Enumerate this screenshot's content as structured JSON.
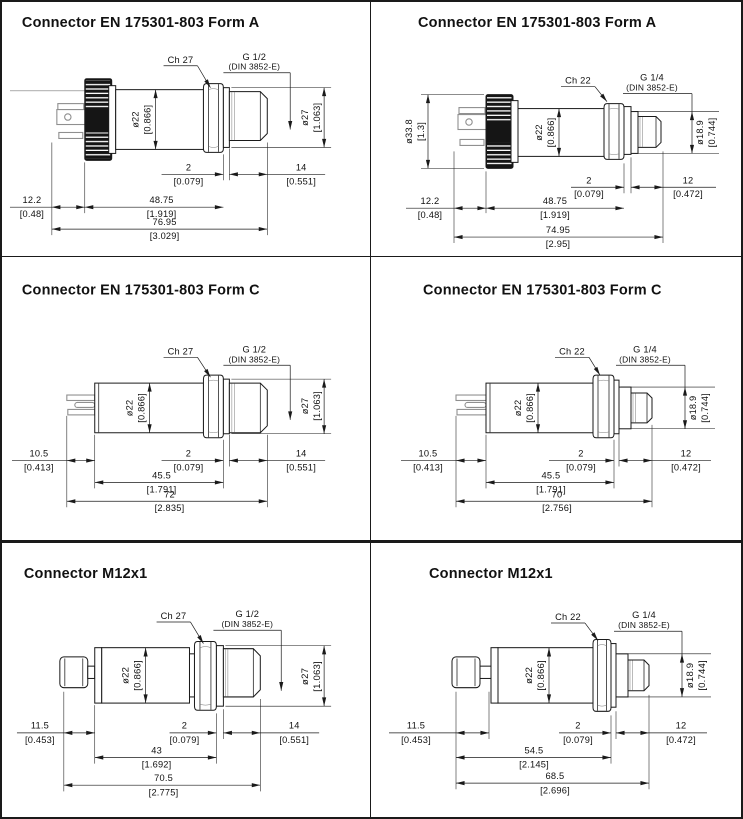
{
  "ink_color": "#1a1a1a",
  "pin_gray_color": "#8f8f8f",
  "panels": [
    {
      "title": "Connector EN 175301-803 Form A",
      "wrench": "Ch 27",
      "thread": "G 1/2",
      "standard": "(DIN 3852-E)",
      "dims": {
        "body_dia_mm": "ø22",
        "body_dia_in": "[0.866]",
        "outlet_dia_mm": "ø27",
        "outlet_dia_in": "[1.063]",
        "seal_mm": "2",
        "seal_in": "[0.079]",
        "thread_len_mm": "14",
        "thread_len_in": "[0.551]",
        "conn_len_mm": "12.2",
        "conn_len_in": "[0.48]",
        "body_len_mm": "48.75",
        "body_len_in": "[1.919]",
        "total_len_mm": "76.95",
        "total_len_in": "[3.029]"
      }
    },
    {
      "title": "Connector EN 175301-803 Form A",
      "wrench": "Ch 22",
      "thread": "G 1/4",
      "standard": "(DIN 3852-E)",
      "dims": {
        "cap_dia_mm": "ø33.8",
        "cap_dia_in": "[1.3]",
        "body_dia_mm": "ø22",
        "body_dia_in": "[0.866]",
        "outlet_dia_mm": "ø18.9",
        "outlet_dia_in": "[0.744]",
        "seal_mm": "2",
        "seal_in": "[0.079]",
        "thread_len_mm": "12",
        "thread_len_in": "[0.472]",
        "conn_len_mm": "12.2",
        "conn_len_in": "[0.48]",
        "body_len_mm": "48.75",
        "body_len_in": "[1.919]",
        "total_len_mm": "74.95",
        "total_len_in": "[2.95]"
      }
    },
    {
      "title": "Connector EN 175301-803 Form C",
      "wrench": "Ch 27",
      "thread": "G 1/2",
      "standard": "(DIN 3852-E)",
      "dims": {
        "body_dia_mm": "ø22",
        "body_dia_in": "[0.866]",
        "outlet_dia_mm": "ø27",
        "outlet_dia_in": "[1.063]",
        "seal_mm": "2",
        "seal_in": "[0.079]",
        "thread_len_mm": "14",
        "thread_len_in": "[0.551]",
        "conn_len_mm": "10.5",
        "conn_len_in": "[0.413]",
        "body_len_mm": "45.5",
        "body_len_in": "[1.791]",
        "total_len_mm": "72",
        "total_len_in": "[2.835]"
      }
    },
    {
      "title": "Connector EN 175301-803 Form C",
      "wrench": "Ch 22",
      "thread": "G 1/4",
      "standard": "(DIN 3852-E)",
      "dims": {
        "body_dia_mm": "ø22",
        "body_dia_in": "[0.866]",
        "outlet_dia_mm": "ø18.9",
        "outlet_dia_in": "[0.744]",
        "seal_mm": "2",
        "seal_in": "[0.079]",
        "thread_len_mm": "12",
        "thread_len_in": "[0.472]",
        "conn_len_mm": "10.5",
        "conn_len_in": "[0.413]",
        "body_len_mm": "45.5",
        "body_len_in": "[1.791]",
        "total_len_mm": "70",
        "total_len_in": "[2.756]"
      }
    },
    {
      "title": "Connector M12x1",
      "wrench": "Ch 27",
      "thread": "G 1/2",
      "standard": "(DIN 3852-E)",
      "dims": {
        "body_dia_mm": "ø22",
        "body_dia_in": "[0.866]",
        "outlet_dia_mm": "ø27",
        "outlet_dia_in": "[1.063]",
        "seal_mm": "2",
        "seal_in": "[0.079]",
        "thread_len_mm": "14",
        "thread_len_in": "[0.551]",
        "conn_len_mm": "11.5",
        "conn_len_in": "[0.453]",
        "body_len_mm": "43",
        "body_len_in": "[1.692]",
        "total_len_mm": "70.5",
        "total_len_in": "[2.775]"
      }
    },
    {
      "title": "Connector M12x1",
      "wrench": "Ch 22",
      "thread": "G 1/4",
      "standard": "(DIN 3852-E)",
      "dims": {
        "body_dia_mm": "ø22",
        "body_dia_in": "[0.866]",
        "outlet_dia_mm": "ø18.9",
        "outlet_dia_in": "[0.744]",
        "seal_mm": "2",
        "seal_in": "[0.079]",
        "thread_len_mm": "12",
        "thread_len_in": "[0.472]",
        "conn_len_mm": "11.5",
        "conn_len_in": "[0.453]",
        "body_len_mm": "54.5",
        "body_len_in": "[2.145]",
        "total_len_mm": "68.5",
        "total_len_in": "[2.696]"
      }
    }
  ]
}
